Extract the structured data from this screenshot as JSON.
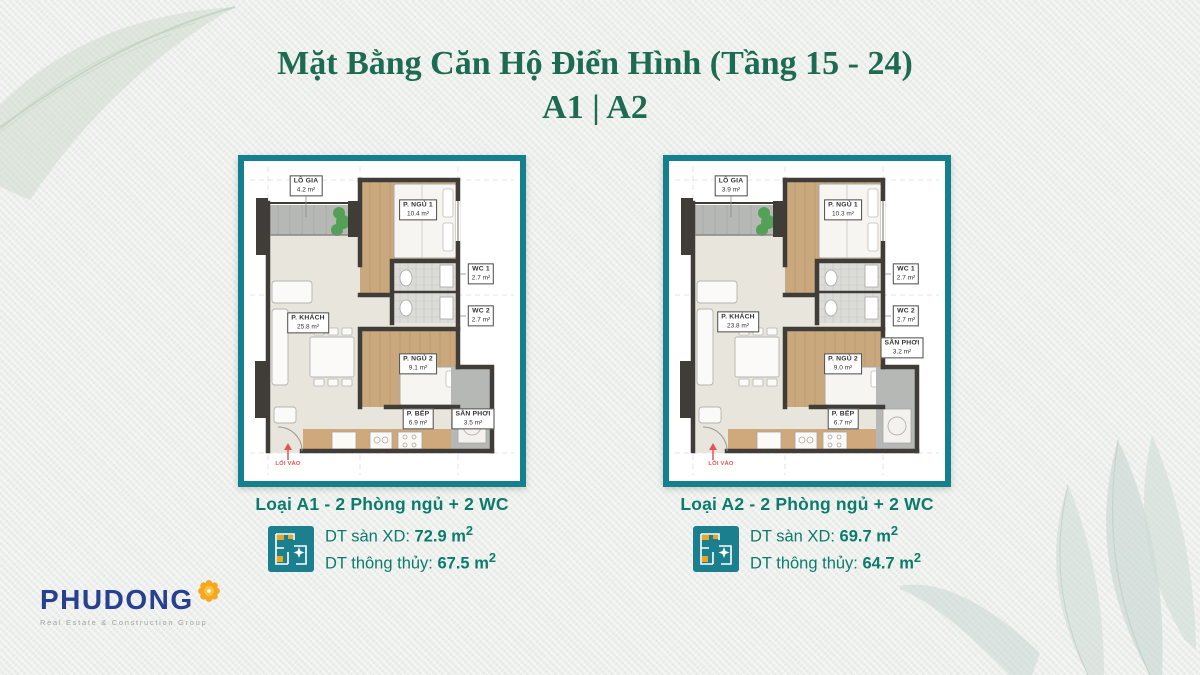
{
  "title": {
    "line1": "Mặt Bằng Căn Hộ Điển Hình (Tầng 15 - 24)",
    "line2": "A1 | A2"
  },
  "plans": [
    {
      "rooms": {
        "lo_gia": {
          "name": "LÔ GIA",
          "area": "4.2 m²"
        },
        "p_ngu1": {
          "name": "P. NGỦ 1",
          "area": "10.4 m²"
        },
        "wc1": {
          "name": "WC 1",
          "area": "2.7 m²"
        },
        "wc2": {
          "name": "WC 2",
          "area": "2.7 m²"
        },
        "p_khach": {
          "name": "P. KHÁCH",
          "area": "25.8 m²"
        },
        "p_ngu2": {
          "name": "P. NGỦ 2",
          "area": "9.1 m²"
        },
        "p_bep": {
          "name": "P. BẾP",
          "area": "6.9 m²"
        },
        "san_phoi": {
          "name": "SÂN PHƠI",
          "area": "3.5 m²"
        },
        "entrance": "LỐI VÀO"
      },
      "caption": {
        "title": "Loại A1 - 2 Phòng ngủ + 2 WC",
        "line1_label": "DT sàn XD:",
        "line1_value": "72.9 m",
        "line1_sup": "2",
        "line2_label": "DT thông thủy:",
        "line2_value": "67.5 m",
        "line2_sup": "2"
      }
    },
    {
      "rooms": {
        "lo_gia": {
          "name": "LÔ GIA",
          "area": "3.9 m²"
        },
        "p_ngu1": {
          "name": "P. NGỦ 1",
          "area": "10.3 m²"
        },
        "wc1": {
          "name": "WC 1",
          "area": "2.7 m²"
        },
        "wc2": {
          "name": "WC 2",
          "area": "2.7 m²"
        },
        "p_khach": {
          "name": "P. KHÁCH",
          "area": "23.8 m²"
        },
        "p_ngu2": {
          "name": "P. NGỦ 2",
          "area": "9.0 m²"
        },
        "p_bep": {
          "name": "P. BẾP",
          "area": "6.7 m²"
        },
        "san_phoi": {
          "name": "SÂN PHƠI",
          "area": "3.2 m²"
        },
        "entrance": "LỐI VÀO"
      },
      "caption": {
        "title": "Loại A2 - 2 Phòng ngủ + 2 WC",
        "line1_label": "DT sàn XD:",
        "line1_value": "69.7 m",
        "line1_sup": "2",
        "line2_label": "DT thông thủy:",
        "line2_value": "64.7 m",
        "line2_sup": "2"
      }
    }
  ],
  "logo": {
    "brand": "PHUDONG",
    "tagline": "Real Estate & Construction Group"
  },
  "colors": {
    "accent_teal": "#14808e",
    "title_green": "#1d6b52",
    "caption_teal": "#0b7c6c",
    "logo_blue": "#27408f",
    "logo_orange": "#f5a81f",
    "entry_red": "#e05555"
  }
}
